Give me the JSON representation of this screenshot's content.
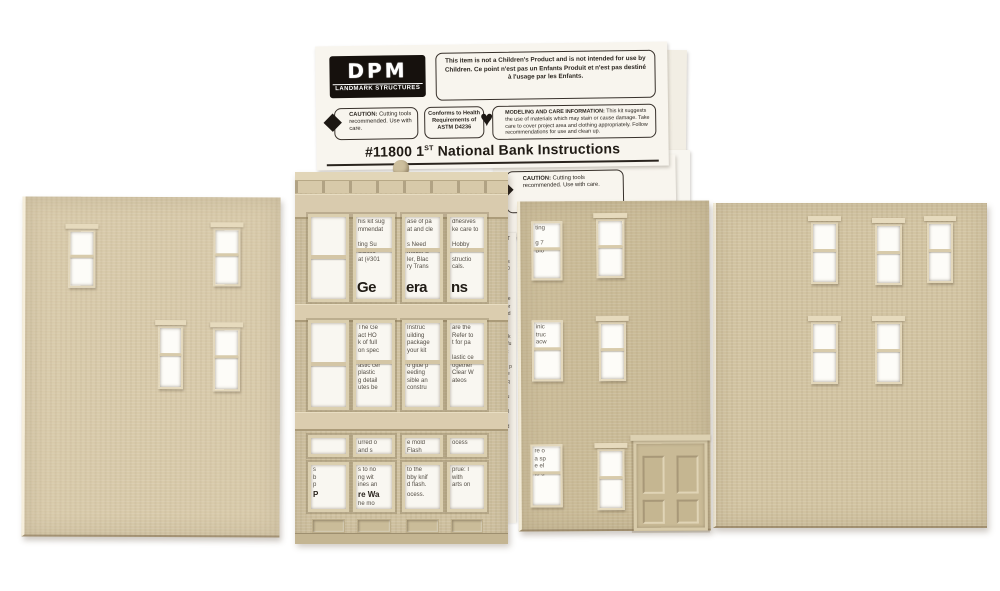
{
  "logo": {
    "name": "DPM",
    "tagline": "LANDMARK STRUCTURES"
  },
  "notices": {
    "children_en": "This item is not a Children's Product and is not intended for use by Children.",
    "children_fr": "Ce point n'est pas un Enfants Produit et n'est pas destiné à l'usage par les Enfants.",
    "caution_label": "CAUTION:",
    "caution_text": " Cutting tools recommended. Use with care.",
    "astm": "Conforms to Health Requirements of ASTM D4236",
    "care_label": "MODELING AND CARE INFORMATION:",
    "care_text": " This kit suggests the use of materials which may stain or cause damage. Take care to cover project area and clothing appropriately. Follow recommendations for use and clean up."
  },
  "title": {
    "prefix": "#11800 1",
    "sup": "ST",
    "rest": " National Bank Instructions"
  },
  "sheet2": {
    "caution_label": "CAUTION:",
    "caution_text": " Cutting tools recommended. Use with care."
  },
  "strip": {
    "lines": "MAT\nt an\n\nPlas\nme0\nSq\n\nHO\nasse\ner pr\nbuild\ntual\n\nwork\narefu\nMat\n\ness p\ncore\ng eq\n\ns pu\nd tr\nuntil\n\naled\nare"
  },
  "facade_windows": {
    "u2": {
      "text": "his kit sug\nmmendat\n\nting Su\nScisso\nat (#301",
      "big": "Ge"
    },
    "u3": {
      "text": "ase of pa\nat and cle\n\ns Need\nModel S\nler, Blac\nry Trans",
      "big": "era"
    },
    "u4": {
      "text": "dhesives\nke care to\n\nHobby\n\nstructio\ncals.",
      "big": "ns"
    },
    "m2": {
      "text": "The Ge\nact HO\nk of full\non spec\n\nastic cer\nplastic\ng detail\nutes be"
    },
    "m3": {
      "text": "Instruc\nuilding\npackage\nyour kit\n\no glue p\needing\nsible an\nconstru"
    },
    "m4": {
      "text": "are the\nRefer to\nt for pa\n\nlastic ce\nogether\nClear W\nateos"
    }
  },
  "transoms": {
    "t1": "",
    "t2": "urred o\nand s",
    "t3": "e mold\nFlash",
    "t4": "ocess"
  },
  "ground": {
    "g1": {
      "t1": "s\nb\np",
      "bold": "P",
      "t2": ""
    },
    "g2": {
      "t1": "s to no\nng wit\nines an",
      "bold": "re Wa",
      "t2": "he mo"
    },
    "g3": {
      "t1": "to the\nbby knif\nd flash.",
      "bold": "",
      "t2": "ocess."
    },
    "g4": {
      "t1": "prue: I\nwith\narts on",
      "bold": "",
      "t2": ""
    }
  },
  "third_windows": {
    "a1": "ting\n\ng 7\nBio",
    "a2": "inic\ntruc\nacw",
    "a3": "re o\na sp\ne el\nto u"
  },
  "colors": {
    "background": "#ffffff",
    "wall_left": "#d8caaa",
    "wall_front": "#cfc1a0",
    "wall_side": "#cabb97",
    "wall_right": "#d2c4a2",
    "paper": "#f8f5ee",
    "ink": "#241f19"
  }
}
